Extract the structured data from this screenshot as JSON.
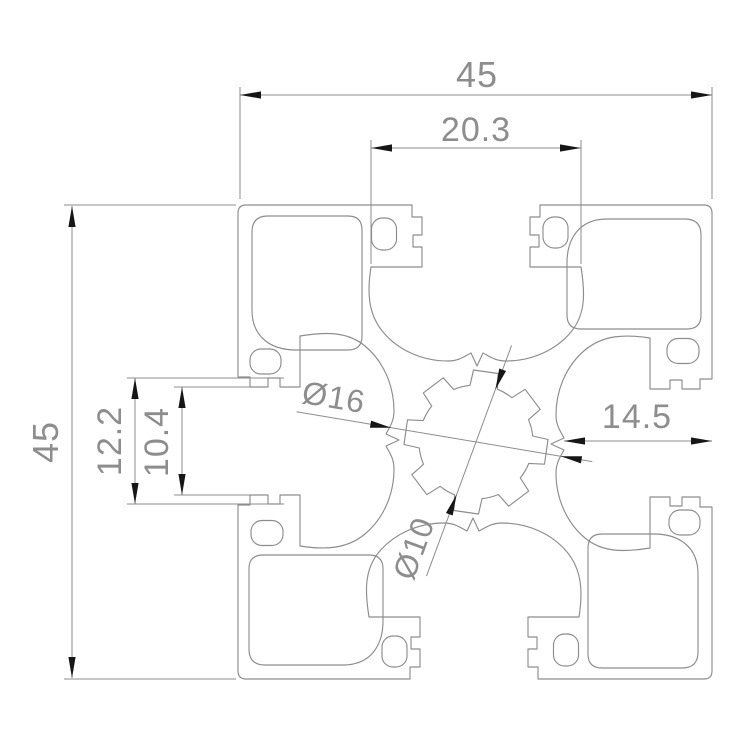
{
  "drawing": {
    "dimensions": {
      "overall_width": "45",
      "overall_height": "45",
      "slot_cavity_width": "20.3",
      "slot_notch_width": "12.2",
      "slot_opening_width": "10.4",
      "face_to_core": "14.5",
      "core_outer_dia": "Ø16",
      "core_inner_dia": "Ø10"
    },
    "colors": {
      "line": "#8d8d8d",
      "arrow": "#161616",
      "text": "#8d8d8d",
      "background": "#ffffff"
    }
  }
}
